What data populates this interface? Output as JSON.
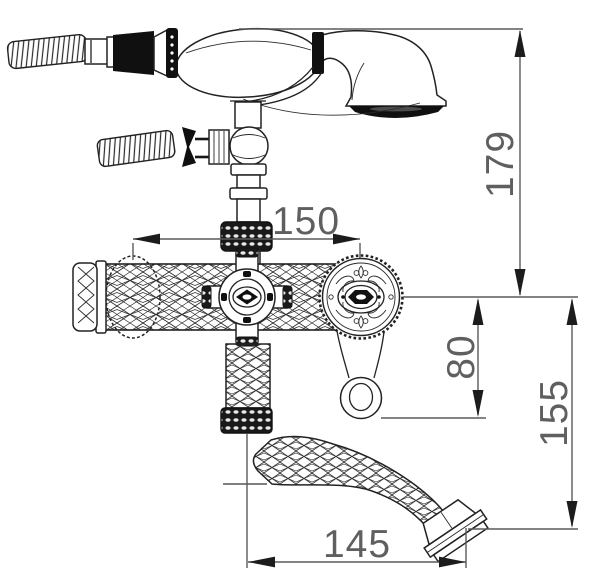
{
  "drawing": {
    "type": "technical-dimension-drawing",
    "subject": "wall-mount bathtub faucet with handheld shower and curved spout",
    "colors": {
      "line": "#222222",
      "dimension_line": "#5a5a5a",
      "background": "#ffffff"
    },
    "dims": {
      "overall_height": "179",
      "valve_centers": "150",
      "handle_drop": "80",
      "spout_drop": "155",
      "spout_reach": "145"
    }
  }
}
